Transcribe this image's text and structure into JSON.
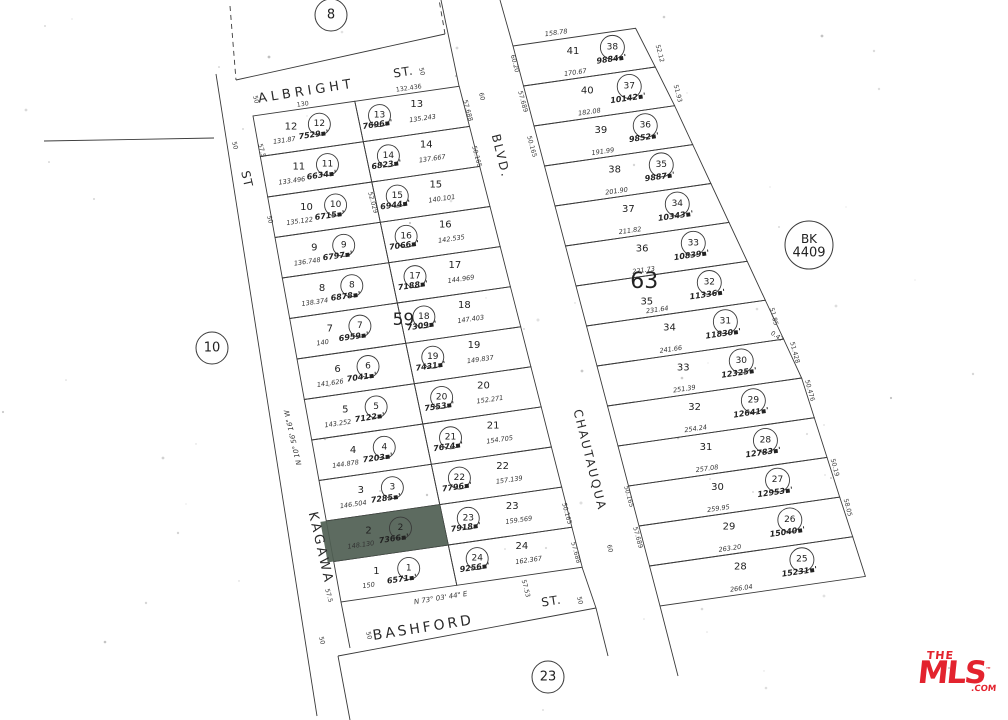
{
  "highlight_color": "#4f5e53",
  "line_color": "#3a3a3a",
  "area_suffix": "▪'",
  "streets": [
    "ALBRIGHT",
    "ST.",
    "ST",
    "KAGAWA",
    "BLVD.",
    "CHAUTAUQUA",
    "BASHFORD",
    "ST."
  ],
  "bearings": [
    "N 10° 56' 16\" W",
    "N 73° 03' 44\" E"
  ],
  "circle_markers": [
    "8",
    "10",
    "23"
  ],
  "bk_marker": {
    "line1": "BK",
    "line2": "4409"
  },
  "block_labels": [
    "59",
    "63"
  ],
  "block59": {
    "west_lots": [
      {
        "lot": "12",
        "circle": "12",
        "area": "7529",
        "dim": "131.87"
      },
      {
        "lot": "11",
        "circle": "11",
        "area": "6634",
        "dim": "133.496"
      },
      {
        "lot": "10",
        "circle": "10",
        "area": "6715",
        "dim": "135.122"
      },
      {
        "lot": "9",
        "circle": "9",
        "area": "6797",
        "dim": "136.748"
      },
      {
        "lot": "8",
        "circle": "8",
        "area": "6878",
        "dim": "138.374"
      },
      {
        "lot": "7",
        "circle": "7",
        "area": "6959",
        "dim": "140"
      },
      {
        "lot": "6",
        "circle": "6",
        "area": "7041",
        "dim": "141.626"
      },
      {
        "lot": "5",
        "circle": "5",
        "area": "7122",
        "dim": "143.252"
      },
      {
        "lot": "4",
        "circle": "4",
        "area": "7203",
        "dim": "144.878"
      },
      {
        "lot": "3",
        "circle": "3",
        "area": "7285",
        "dim": "146.504"
      },
      {
        "lot": "2",
        "circle": "2",
        "area": "7366",
        "dim": "148.130",
        "highlight": true
      },
      {
        "lot": "1",
        "circle": "1",
        "area": "6571",
        "dim": "150"
      }
    ],
    "east_lots": [
      {
        "lot": "13",
        "circle": "13",
        "area": "7696",
        "dim": "135.243"
      },
      {
        "lot": "14",
        "circle": "14",
        "area": "6823",
        "dim": "137.667"
      },
      {
        "lot": "15",
        "circle": "15",
        "area": "6944",
        "dim": "140.101"
      },
      {
        "lot": "16",
        "circle": "16",
        "area": "7066",
        "dim": "142.535"
      },
      {
        "lot": "17",
        "circle": "17",
        "area": "7188",
        "dim": "144.969"
      },
      {
        "lot": "18",
        "circle": "18",
        "area": "7309",
        "dim": "147.403"
      },
      {
        "lot": "19",
        "circle": "19",
        "area": "7431",
        "dim": "149.837"
      },
      {
        "lot": "20",
        "circle": "20",
        "area": "7553",
        "dim": "152.271"
      },
      {
        "lot": "21",
        "circle": "21",
        "area": "7674",
        "dim": "154.705"
      },
      {
        "lot": "22",
        "circle": "22",
        "area": "7796",
        "dim": "157.139"
      },
      {
        "lot": "23",
        "circle": "23",
        "area": "7918",
        "dim": "159.569"
      },
      {
        "lot": "24",
        "circle": "24",
        "area": "9256",
        "dim": "162.367"
      }
    ]
  },
  "block63": {
    "top_dim": "158.78",
    "lots": [
      {
        "lot": "41",
        "circle": "38",
        "area": "9884",
        "dim": "170.67"
      },
      {
        "lot": "40",
        "circle": "37",
        "area": "10142",
        "dim": "182.08"
      },
      {
        "lot": "39",
        "circle": "36",
        "area": "9852",
        "dim": "191.99"
      },
      {
        "lot": "38",
        "circle": "35",
        "area": "9887",
        "dim": "201.90"
      },
      {
        "lot": "37",
        "circle": "34",
        "area": "10343",
        "dim": "211.82"
      },
      {
        "lot": "36",
        "circle": "33",
        "area": "10839",
        "dim": "221.73"
      },
      {
        "lot": "35",
        "circle": "32",
        "area": "11336",
        "dim": "231.64"
      },
      {
        "lot": "34",
        "circle": "31",
        "area": "11830",
        "dim": "241.66"
      },
      {
        "lot": "33",
        "circle": "30",
        "area": "12325",
        "dim": "251.39"
      },
      {
        "lot": "32",
        "circle": "29",
        "area": "12641",
        "dim": "254.24"
      },
      {
        "lot": "31",
        "circle": "28",
        "area": "12783",
        "dim": "257.08"
      },
      {
        "lot": "30",
        "circle": "27",
        "area": "12953",
        "dim": "259.95"
      },
      {
        "lot": "29",
        "circle": "26",
        "area": "15040",
        "dim": "263.20"
      },
      {
        "lot": "28",
        "circle": "25",
        "area": "15231",
        "dim": "266.04"
      }
    ]
  },
  "edge_labels": [
    "50",
    "50",
    "130",
    "132.436",
    "57.688",
    "50.165",
    "60",
    "60.20",
    "57.689",
    "50.165",
    "52.12",
    "51.93",
    "50",
    "57.5",
    "50",
    "52.029",
    "50.165",
    "57.688",
    "50.165",
    "57.689",
    "60",
    "57.5",
    "50",
    "50",
    "57.53",
    "50",
    "51.85",
    "51.428",
    "0.47",
    "50.476",
    "50.19",
    "58.05"
  ],
  "logo": {
    "the": "THE",
    "mls": "MLS",
    "tm": "™",
    "com": ".COM",
    "color": "#e3232e"
  }
}
